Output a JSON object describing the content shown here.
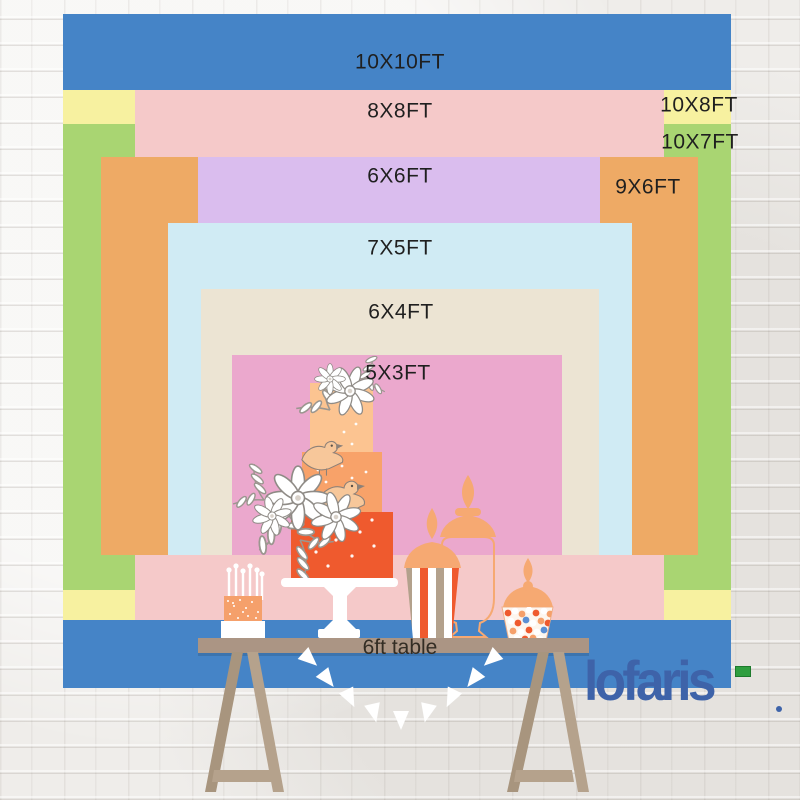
{
  "backdrops": {
    "b10x10": {
      "label": "10X10FT",
      "color": "#4584c7"
    },
    "b10x8": {
      "label": "10X8FT",
      "color": "#f7f1a0"
    },
    "b10x7": {
      "label": "10X7FT",
      "color": "#a9d572"
    },
    "b8x8": {
      "label": "8X8FT",
      "color": "#f5c9c9"
    },
    "b9x6": {
      "label": "9X6FT",
      "color": "#eeaa65"
    },
    "b6x6": {
      "label": "6X6FT",
      "color": "#dabdee"
    },
    "b7x5": {
      "label": "7X5FT",
      "color": "#d0ebf4"
    },
    "b6x4": {
      "label": "6X4FT",
      "color": "#ece4d3"
    },
    "b5x3": {
      "label": "5X3FT",
      "color": "#eba8cd"
    }
  },
  "table": {
    "label": "6ft table"
  },
  "brand": {
    "name": "lofaris",
    "color": "#3e63a9",
    "accent_green": "#2f9e3f"
  }
}
